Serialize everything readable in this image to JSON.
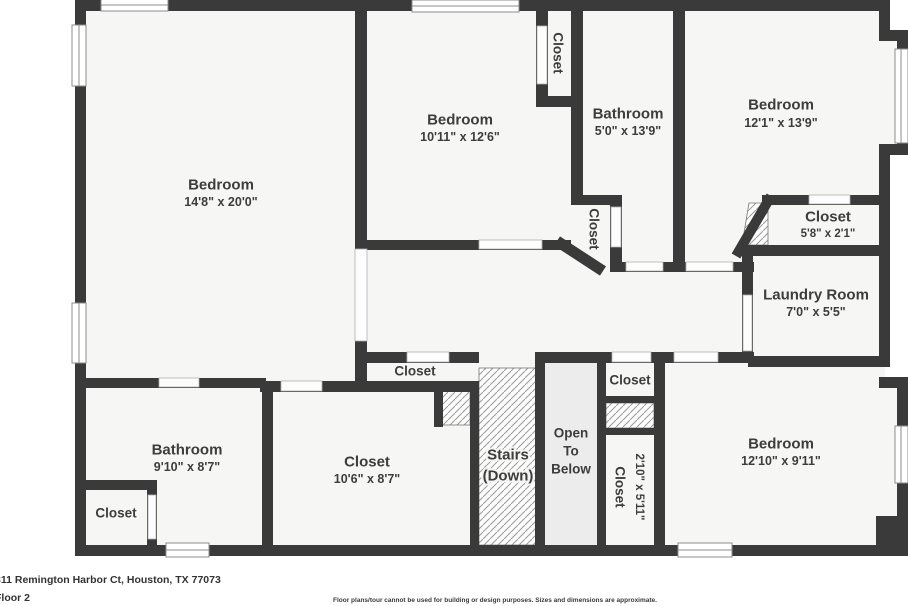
{
  "meta": {
    "address": "311 Remington Harbor Ct, Houston, TX 77073",
    "floor_label": "Floor 2",
    "disclaimer": "Floor plans/tour cannot be used for building or design purposes. Sizes and dimensions are approximate."
  },
  "colors": {
    "wall": "#3a3a3a",
    "floor": "#f6f6f5",
    "open_area": "#ececec",
    "label": "#3d3d3d"
  },
  "rooms": {
    "bedroom_top_left": {
      "name": "Bedroom",
      "dims": "14'8\" x 20'0\""
    },
    "bedroom_top_middle": {
      "name": "Bedroom",
      "dims": "10'11\" x 12'6\""
    },
    "bathroom_top": {
      "name": "Bathroom",
      "dims": "5'0\" x 13'9\""
    },
    "bedroom_top_right": {
      "name": "Bedroom",
      "dims": "12'1\" x 13'9\""
    },
    "closet_top": {
      "name": "Closet"
    },
    "closet_mid": {
      "name": "Closet"
    },
    "closet_by_bedroom": {
      "name": "Closet",
      "dims": "5'8\" x 2'1\""
    },
    "laundry": {
      "name": "Laundry Room",
      "dims": "7'0\" x 5'5\""
    },
    "closet_hall_west": {
      "name": "Closet"
    },
    "closet_hall_east": {
      "name": "Closet"
    },
    "closet_narrow": {
      "name": "Closet",
      "dims": "2'10\" x 5'11\""
    },
    "stairs": {
      "line1": "Stairs",
      "line2": "(Down)"
    },
    "open_to_below": {
      "line1": "Open",
      "line2": "To",
      "line3": "Below"
    },
    "bathroom_bottom": {
      "name": "Bathroom",
      "dims": "9'10\" x 8'7\""
    },
    "closet_bottom_large": {
      "name": "Closet",
      "dims": "10'6\" x 8'7\""
    },
    "closet_bottom_small": {
      "name": "Closet"
    },
    "bedroom_bottom_right": {
      "name": "Bedroom",
      "dims": "12'10\" x 9'11\""
    }
  }
}
